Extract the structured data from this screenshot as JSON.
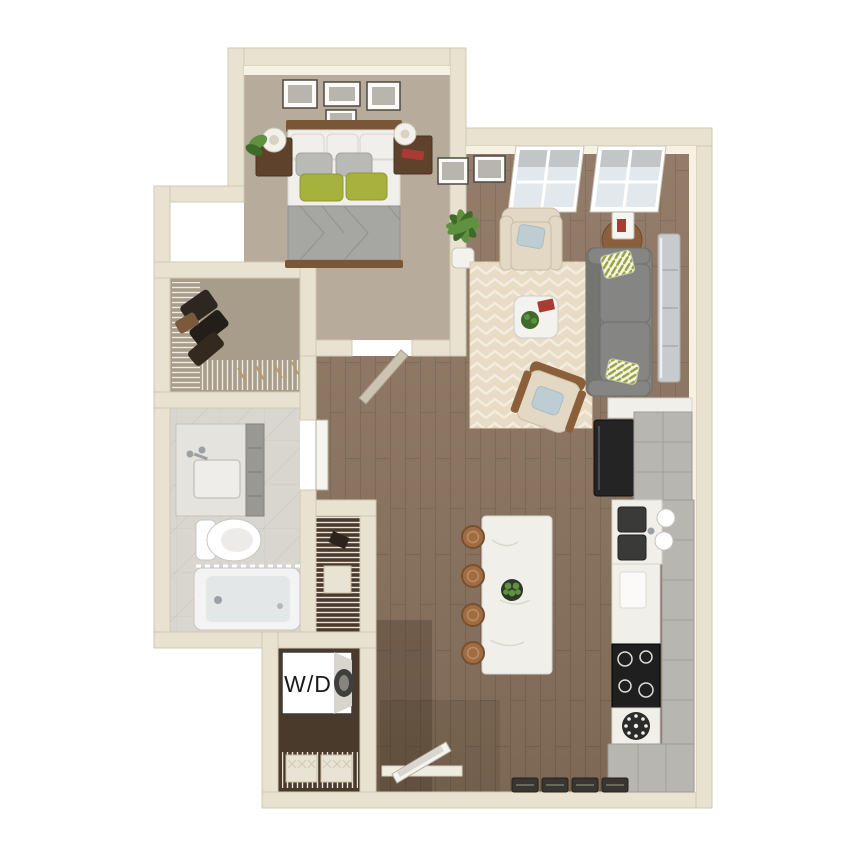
{
  "labels": {
    "washer_dryer": "W/D"
  },
  "palette": {
    "bg": "#ffffff",
    "wall": "#e9e2d1",
    "wall_edge": "#cfc8b2",
    "wall_face": "#f6f1e3",
    "carpet": "#b7ac9b",
    "carpet_dark": "#a89d8b",
    "wood": "#8d7560",
    "wood_line": "#6f5b49",
    "wood_dark": "#4a3a2b",
    "marble": "#d9d6d0",
    "marble_line": "#c7c3bc",
    "rug": "#e8dcc7",
    "rug_edge": "#dbcdb3",
    "rug_line": "#f5eede",
    "wire": "#f2efe6",
    "sofa": "#858583",
    "sofa_dark": "#747470",
    "pillow_gray": "#b9b9b6",
    "pillow_green": "#a7b13e",
    "pillow_blue": "#becdd4",
    "bed_white": "#f1efeb",
    "blanket": "#a6a6a3",
    "wood_brown": "#7a5639",
    "nightstand": "#5f422c",
    "cream_chair": "#e3d8c4",
    "island": "#f1efea",
    "stool": "#a06c44",
    "black": "#242424",
    "cabinet": "#b8b6b1",
    "cabinet_line": "#9d9b96",
    "steel": "#c7cbcd",
    "mat": "#393530",
    "basket": "#e8e3d3",
    "green": "#5f9140",
    "green_dark": "#3e6b2a",
    "white": "#ffffff",
    "tub": "#e3e7e7",
    "chrome": "#9aa0a4",
    "red": "#a83b33"
  }
}
